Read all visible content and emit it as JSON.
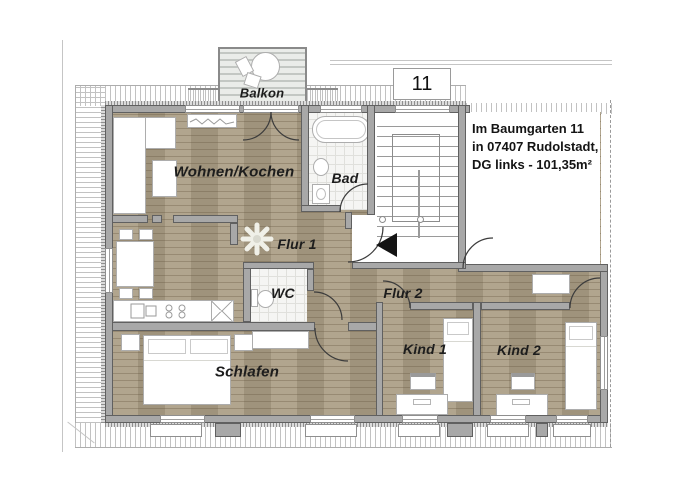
{
  "house_number": "11",
  "address": {
    "line1": "Im Baumgarten 11",
    "line2": "in 07407 Rudolstadt,",
    "line3": "DG links - 101,35m²"
  },
  "rooms": {
    "balkon": "Balkon",
    "wohnen_kochen": "Wohnen/Kochen",
    "bad": "Bad",
    "flur1": "Flur 1",
    "wc": "WC",
    "flur2": "Flur 2",
    "schlafen": "Schlafen",
    "kind1": "Kind 1",
    "kind2": "Kind 2"
  },
  "colors": {
    "floor_wood": "#ab9e85",
    "wall": "#a8a8a8",
    "tile_floor": "#f5f5f3",
    "roof_hatch": "#c2c2c2",
    "entrance_arrow": "#141414",
    "text": "#141414"
  }
}
